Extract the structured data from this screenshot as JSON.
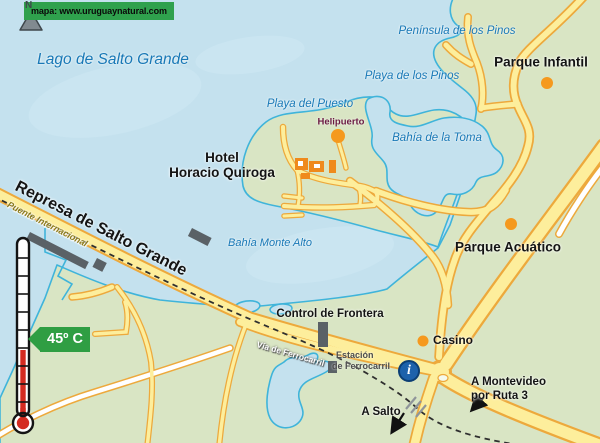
{
  "map": {
    "source_label": "mapa: www.uruguaynatural.com",
    "compass": "N",
    "temperature_tag": "45º C",
    "info_icon_glyph": "i",
    "labels": {
      "lago": "Lago de Salto Grande",
      "peninsula_pinos": "Península de los Pinos",
      "playa_pinos": "Playa de los Pinos",
      "parque_infantil": "Parque Infantil",
      "playa_puesto": "Playa del Puesto",
      "helipuerto": "Helipuerto",
      "bahia_toma": "Bahía de la Toma",
      "hotel_line1": "Hotel",
      "hotel_line2": "Horacio Quiroga",
      "represa": "Represa de Salto Grande",
      "puente": "Puente Internacional",
      "bahia_monte_alto": "Bahía Monte Alto",
      "parque_acuatico": "Parque Acuático",
      "control_frontera": "Control de Frontera",
      "casino": "Casino",
      "via_ferrocarril": "Vía de Ferrocarril",
      "estacion_line1": "Estación",
      "estacion_line2": "de Ferrocarril",
      "a_salto": "A Salto",
      "montevideo_line1": "A Montevideo",
      "montevideo_line2": "por Ruta 3"
    },
    "colors": {
      "water": "#c4e1ee",
      "water_light": "#cfe9f4",
      "land": "#d9e5c4",
      "coast": "#3fb4da",
      "road_fill": "#fdee9c",
      "road_casing": "#eda93c",
      "road_white": "#ffffff",
      "railway": "#2f2f2f",
      "dot_orange": "#f5991e",
      "building_orange": "#ef8a1c",
      "structure_gray": "#5a6166",
      "crossing_gray": "#8f959a",
      "banner_green": "#2fa14d",
      "tag_green": "#2f9e43",
      "label_blue": "#1878b6",
      "label_black": "#141414",
      "helipuerto_maroon": "#6b1a42",
      "estacion_gray": "#4c4c4c",
      "puente_olive": "#8a7a1a",
      "info_blue": "#1d62ab",
      "thermo_red": "#d42b20"
    }
  }
}
